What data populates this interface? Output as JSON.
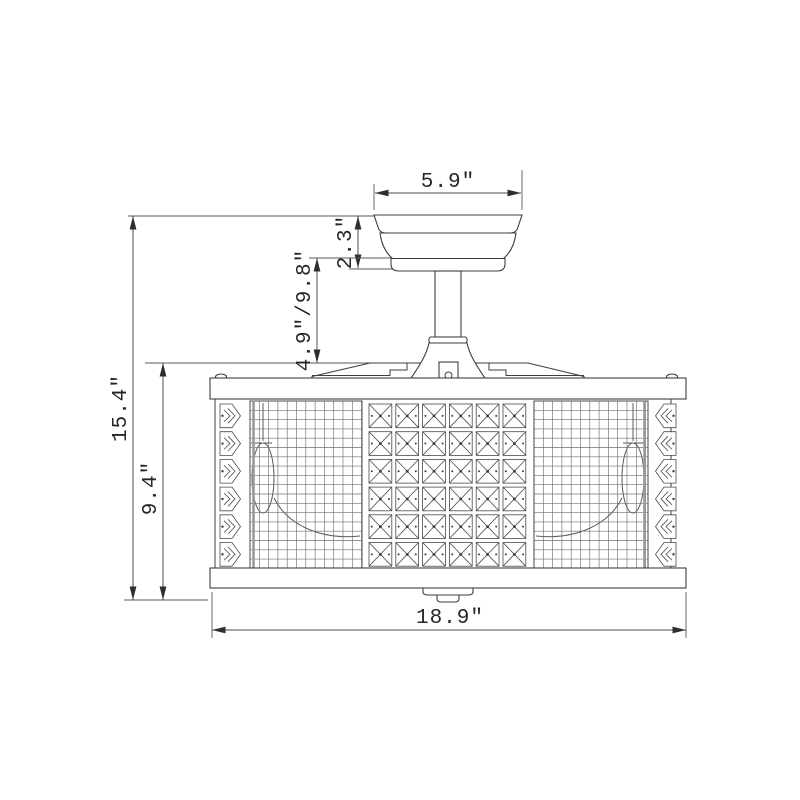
{
  "diagram": {
    "type": "technical-dimension-drawing",
    "subject": "caged crystal ceiling fan light (fandelier), front elevation with dimensions",
    "line_color": "#3e3e3e",
    "background_color": "#ffffff",
    "dimensions": {
      "canopy_width": "5.9″",
      "canopy_height": "2.3″",
      "downrod_length": "4.9″/9.8″",
      "total_height": "15.4″",
      "shade_height": "9.4″",
      "shade_width": "18.9″"
    }
  },
  "drawing": {
    "crystal_grid": {
      "rows": 6,
      "cols": 6,
      "cell_w": 26.8,
      "cell_h": 27.7,
      "x": 367,
      "y": 402
    },
    "chevrons": {
      "rows": 6,
      "cell_w": 24,
      "cell_h": 27.7,
      "y": 402,
      "left_x": 219,
      "right_x": 653
    },
    "mesh": {
      "step_x": 9.3,
      "step_y": 9.3,
      "panels": [
        [
          250,
          401,
          112,
          169
        ],
        [
          534,
          401,
          114,
          169
        ]
      ]
    }
  }
}
